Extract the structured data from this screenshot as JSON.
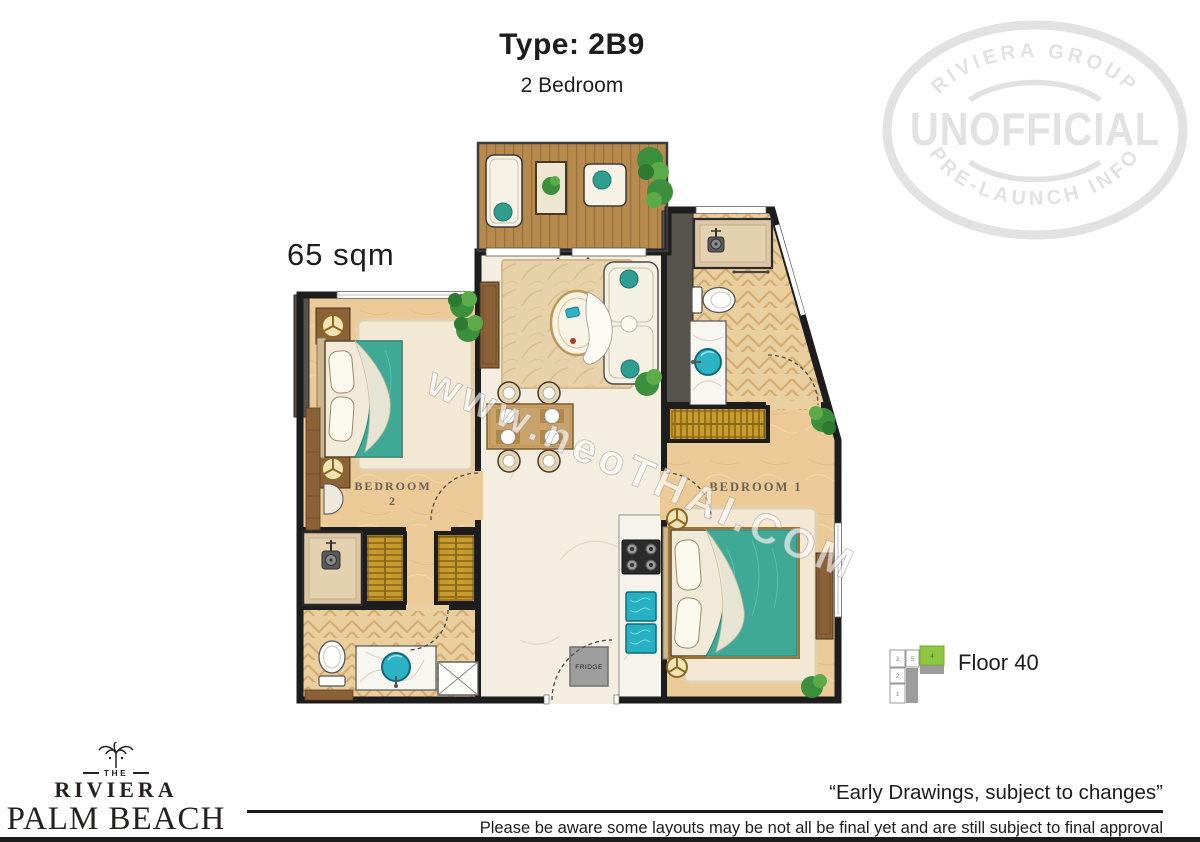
{
  "header": {
    "type_title": "Type: 2B9",
    "subtitle": "2 Bedroom",
    "area_label": "65 sqm"
  },
  "stamp": {
    "arc_top": "RIVIERA GROUP",
    "main": "UNOFFICIAL",
    "arc_bottom": "PRE-LAUNCH INFO",
    "color": "#e2e2e2"
  },
  "plan": {
    "watermark": "www.neoTHAI.COM",
    "labels": {
      "bedroom1": "BEDROOM 1",
      "bedroom2_line1": "BEDROOM",
      "bedroom2_line2": "2",
      "fridge": "FRIDGE"
    },
    "colors": {
      "wall_black": "#1d1d1d",
      "bedding_teal": "#3fa996",
      "water_teal": "#2cb3c6",
      "wardrobe_gold": "#c89b2f",
      "balcony_wood": "#b6894d",
      "bedroom_sand": "#ecca97"
    }
  },
  "floor_indicator": {
    "label": "Floor 40",
    "highlight_color": "#8ec641",
    "cells": {
      "c3": "3",
      "c5": "5",
      "c4": "4",
      "c2": "2",
      "c1": "1"
    }
  },
  "footer": {
    "logo": {
      "the": "THE",
      "name": "RIVIERA",
      "main": "PALM BEACH",
      "sub": "WONGAMAT"
    },
    "quote": "“Early Drawings, subject to changes”",
    "disclaimer": "Please be aware some layouts may be not all be final yet and are still subject to final approval"
  }
}
